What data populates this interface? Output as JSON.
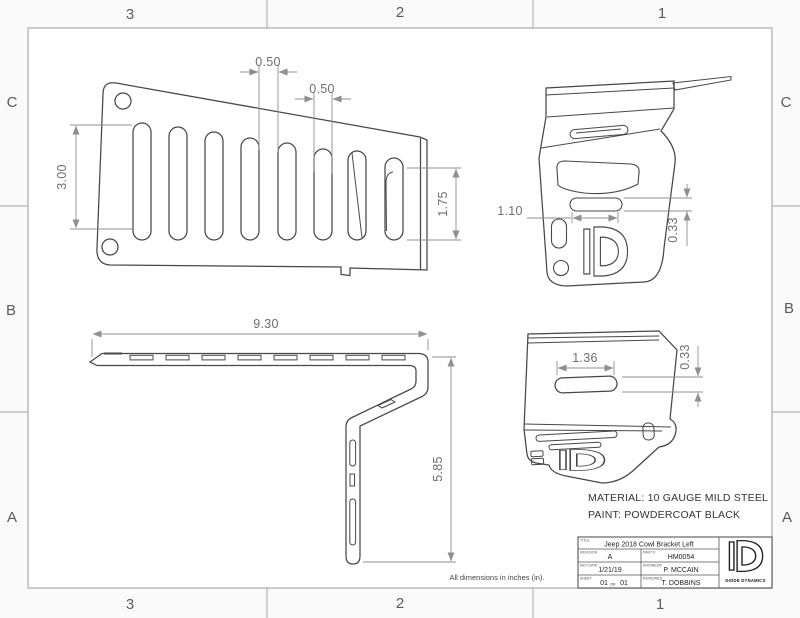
{
  "sheet": {
    "zone_columns": [
      "3",
      "2",
      "1"
    ],
    "zone_rows": [
      "C",
      "B",
      "A"
    ],
    "units_note": "All dimensions in inches (in).",
    "material_note_line1": "MATERIAL: 10 GAUGE MILD STEEL",
    "material_note_line2": "PAINT: POWDERCOAT BLACK"
  },
  "views": {
    "front": {
      "dim_slot_gap": "0.50",
      "dim_slot_width": "0.50",
      "dim_slot_height": "3.00",
      "dim_end_slot_height": "1.75"
    },
    "iso_top": {
      "dim_slot_width": "1.10",
      "dim_slot_height": "0.33"
    },
    "side": {
      "dim_length": "9.30",
      "dim_height": "5.85"
    },
    "iso_bottom": {
      "dim_slot_width": "1.36",
      "dim_slot_height": "0.33"
    }
  },
  "title_block": {
    "title_label": "TITLE",
    "title": "Jeep 2018 Cowl Bracket Left",
    "revision_label": "REVISION",
    "revision": "A",
    "part_label": "PART #",
    "part_number": "HM0054",
    "rev_date_label": "REV DATE",
    "rev_date": "1/21/19",
    "engineer_label": "ENGINEER",
    "engineer": "P. MCCAIN",
    "sheet_label": "SHEET",
    "sheet_number": "01",
    "sheet_of": "OF",
    "sheet_total": "01",
    "reviewed_label": "REVIEWED",
    "reviewed": "T. DOBBINS",
    "company": "DIODE DYNAMICS"
  },
  "colors": {
    "part_line": "#474747",
    "dim_line": "#8f8f8f",
    "frame_line": "#b5b5b5",
    "background": "#ffffff"
  }
}
